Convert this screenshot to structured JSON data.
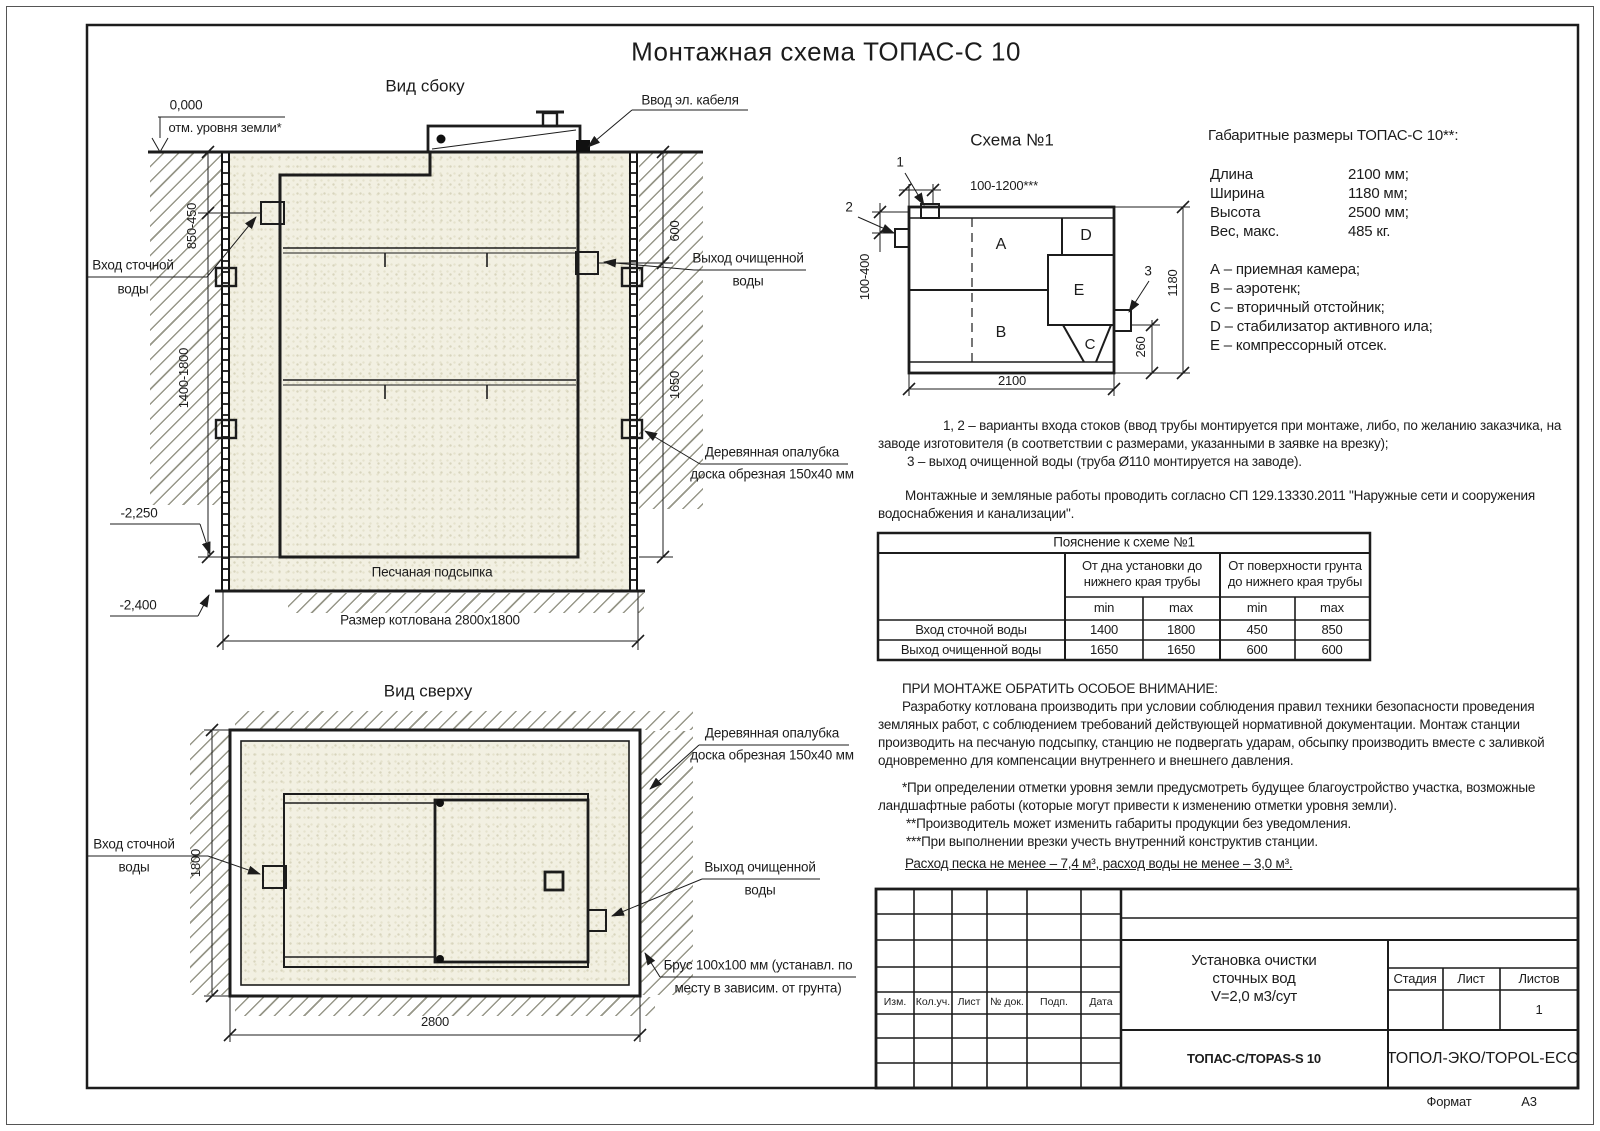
{
  "page": {
    "title": "Монтажная схема ТОПАС-С 10",
    "format_label": "Формат",
    "format_value": "А3"
  },
  "colors": {
    "green": "#3c5c26",
    "sand": "#f2f0e2",
    "line": "#1c1c1c"
  },
  "side_view": {
    "title": "Вид сбоку",
    "elev_zero": "0,000",
    "elev_zero_note": "отм. уровня земли*",
    "cable_label": "Ввод эл. кабеля",
    "dim_850_450": "850-450",
    "dim_600": "600",
    "dim_1400_1800": "1400-1800",
    "dim_1650": "1650",
    "inlet_l1": "Вход сточной",
    "inlet_l2": "воды",
    "outlet_l1": "Выход очищенной",
    "outlet_l2": "воды",
    "elev_2250": "-2,250",
    "elev_2400": "-2,400",
    "sand_label": "Песчаная подсыпка",
    "pit_label": "Размер котлована 2800x1800",
    "formwork_l1": "Деревянная опалубка",
    "formwork_l2": "доска обрезная 150x40 мм"
  },
  "top_view": {
    "title": "Вид сверху",
    "formwork_l1": "Деревянная опалубка",
    "formwork_l2": "доска обрезная 150x40 мм",
    "inlet_l1": "Вход сточной",
    "inlet_l2": "воды",
    "outlet_l1": "Выход очищенной",
    "outlet_l2": "воды",
    "beam_l1": "Брус 100x100 мм (устанавл. по",
    "beam_l2": "месту в зависим. от грунта)",
    "dim_1800": "1800",
    "dim_2800": "2800"
  },
  "schema": {
    "title": "Схема №1",
    "m1": "1",
    "m2": "2",
    "m3": "3",
    "dim_top": "100-1200***",
    "dim_left": "100-400",
    "dim_right": "1180",
    "dim_260": "260",
    "dim_bottom": "2100",
    "a": "А",
    "b": "В",
    "c": "С",
    "d": "D",
    "e": "Е"
  },
  "specs": {
    "heading": "Габаритные размеры ТОПАС-С 10**:",
    "rows": [
      {
        "label": "Длина",
        "value": "2100 мм;"
      },
      {
        "label": "Ширина",
        "value": "1180 мм;"
      },
      {
        "label": "Высота",
        "value": "2500 мм;"
      },
      {
        "label": "Вес, макс.",
        "value": "485 кг."
      }
    ],
    "legend": [
      "А – приемная камера;",
      "В – аэротенк;",
      "С – вторичный отстойник;",
      "D – стабилизатор активного ила;",
      "Е – компрессорный отсек."
    ]
  },
  "notes": {
    "l1": "1, 2 – варианты входа  стоков (ввод трубы монтируется при монтаже, либо, по желанию заказчика, на",
    "l2": "заводе изготовителя (в соответствии с размерами, указанными в заявке на врезку);",
    "l3": "3 – выход очищенной воды (труба Ø110 монтируется на заводе).",
    "l4": "Монтажные и земляные работы проводить согласно СП 129.13330.2011 \"Наружные сети и сооружения",
    "l5": "водоснабжения и канализации\"."
  },
  "table": {
    "title": "Пояснение к схеме №1",
    "group1_l1": "От дна установки до",
    "group1_l2": "нижнего края трубы",
    "group2_l1": "От поверхности грунта",
    "group2_l2": "до нижнего края трубы",
    "min": "min",
    "max": "max",
    "rows": [
      {
        "label": "Вход сточной воды",
        "v1": "1400",
        "v2": "1800",
        "v3": "450",
        "v4": "850"
      },
      {
        "label": "Выход очищенной воды",
        "v1": "1650",
        "v2": "1650",
        "v3": "600",
        "v4": "600"
      }
    ]
  },
  "attention": {
    "heading": "ПРИ МОНТАЖЕ ОБРАТИТЬ ОСОБОЕ ВНИМАНИЕ:",
    "l1": "Разработку котлована производить при условии соблюдения правил техники безопасности проведения",
    "l2": "земляных работ, с соблюдением требований действующей нормативной документации. Монтаж станции",
    "l3": "производить на песчаную подсыпку, станцию не подвергать ударам, обсыпку производить вместе с заливкой",
    "l4": "одновременно для компенсации внутреннего и внешнего давления.",
    "s1": "*При определении отметки уровня земли предусмотреть будущее благоустройство участка, возможные",
    "s2": "ландшафтные работы (которые могут привести к изменению отметки уровня земли).",
    "s3": "**Производитель может изменить габариты продукции без уведомления.",
    "s4": "***При выполнении врезки учесть внутренний конструктив станции.",
    "consumption": "Расход песка не менее – 7,4 м³, расход воды не менее – 3,0 м³."
  },
  "stamp": {
    "cols": [
      "Изм.",
      "Кол.уч.",
      "Лист",
      "№ док.",
      "Подп.",
      "Дата"
    ],
    "doc_l1": "Установка очистки",
    "doc_l2": "сточных вод",
    "doc_l3": "V=2,0 м3/сут",
    "stage": "Стадия",
    "sheet": "Лист",
    "sheets": "Листов",
    "sheets_value": "1",
    "model": "ТОПАС-С/TOPAS-S 10",
    "company": "ТОПОЛ-ЭКО/TOPOL-ECO"
  }
}
